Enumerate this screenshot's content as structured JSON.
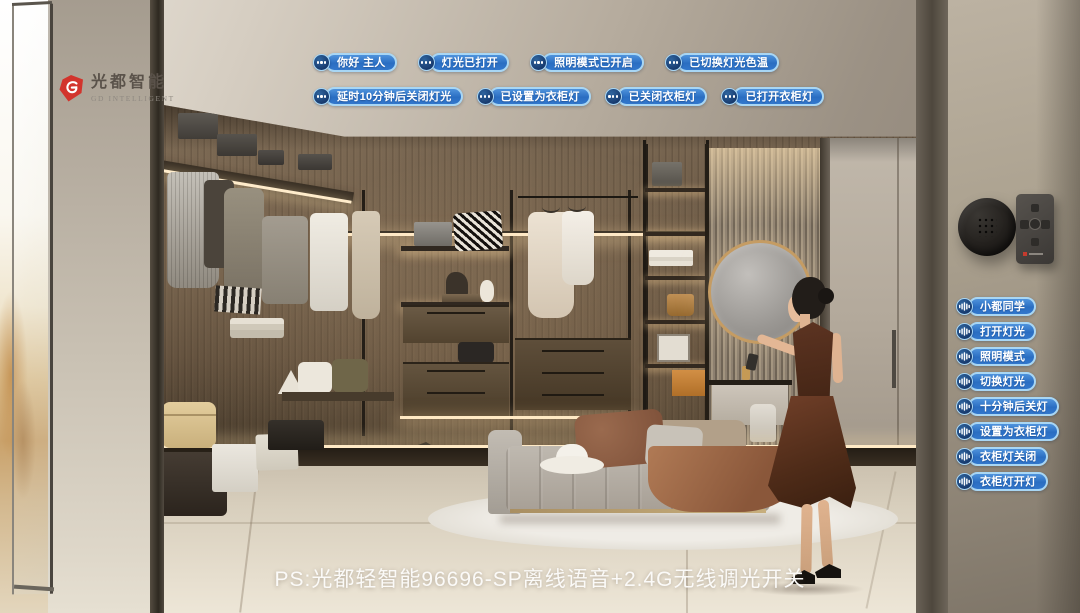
{
  "brand": {
    "name_cn": "光都智能",
    "name_en": "GD INTELLIGENT"
  },
  "voice_replies": {
    "row1": [
      "你好 主人",
      "灯光已打开",
      "照明模式已开启",
      "已切换灯光色温"
    ],
    "row2": [
      "延时10分钟后关闭灯光",
      "已设置为衣柜灯",
      "已关闭衣柜灯",
      "已打开衣柜灯"
    ]
  },
  "voice_commands": [
    "小都同学",
    "打开灯光",
    "照明模式",
    "切换灯光",
    "十分钟后关灯",
    "设置为衣柜灯",
    "衣柜灯关闭",
    "衣柜灯开灯"
  ],
  "caption": "PS:光都轻智能96696-SP离线语音+2.4G无线调光开关",
  "icons": {
    "reply_bubble": "ellipsis-icon",
    "command_bubble": "voice-wave-icon",
    "logo_mark": "gd-logo-mark-icon"
  },
  "colors": {
    "bubble_fill": "#2e74c8",
    "bubble_border": "#a8d6f4",
    "bubble_circle": "#1a3f74",
    "logo_red": "#d2342c"
  }
}
